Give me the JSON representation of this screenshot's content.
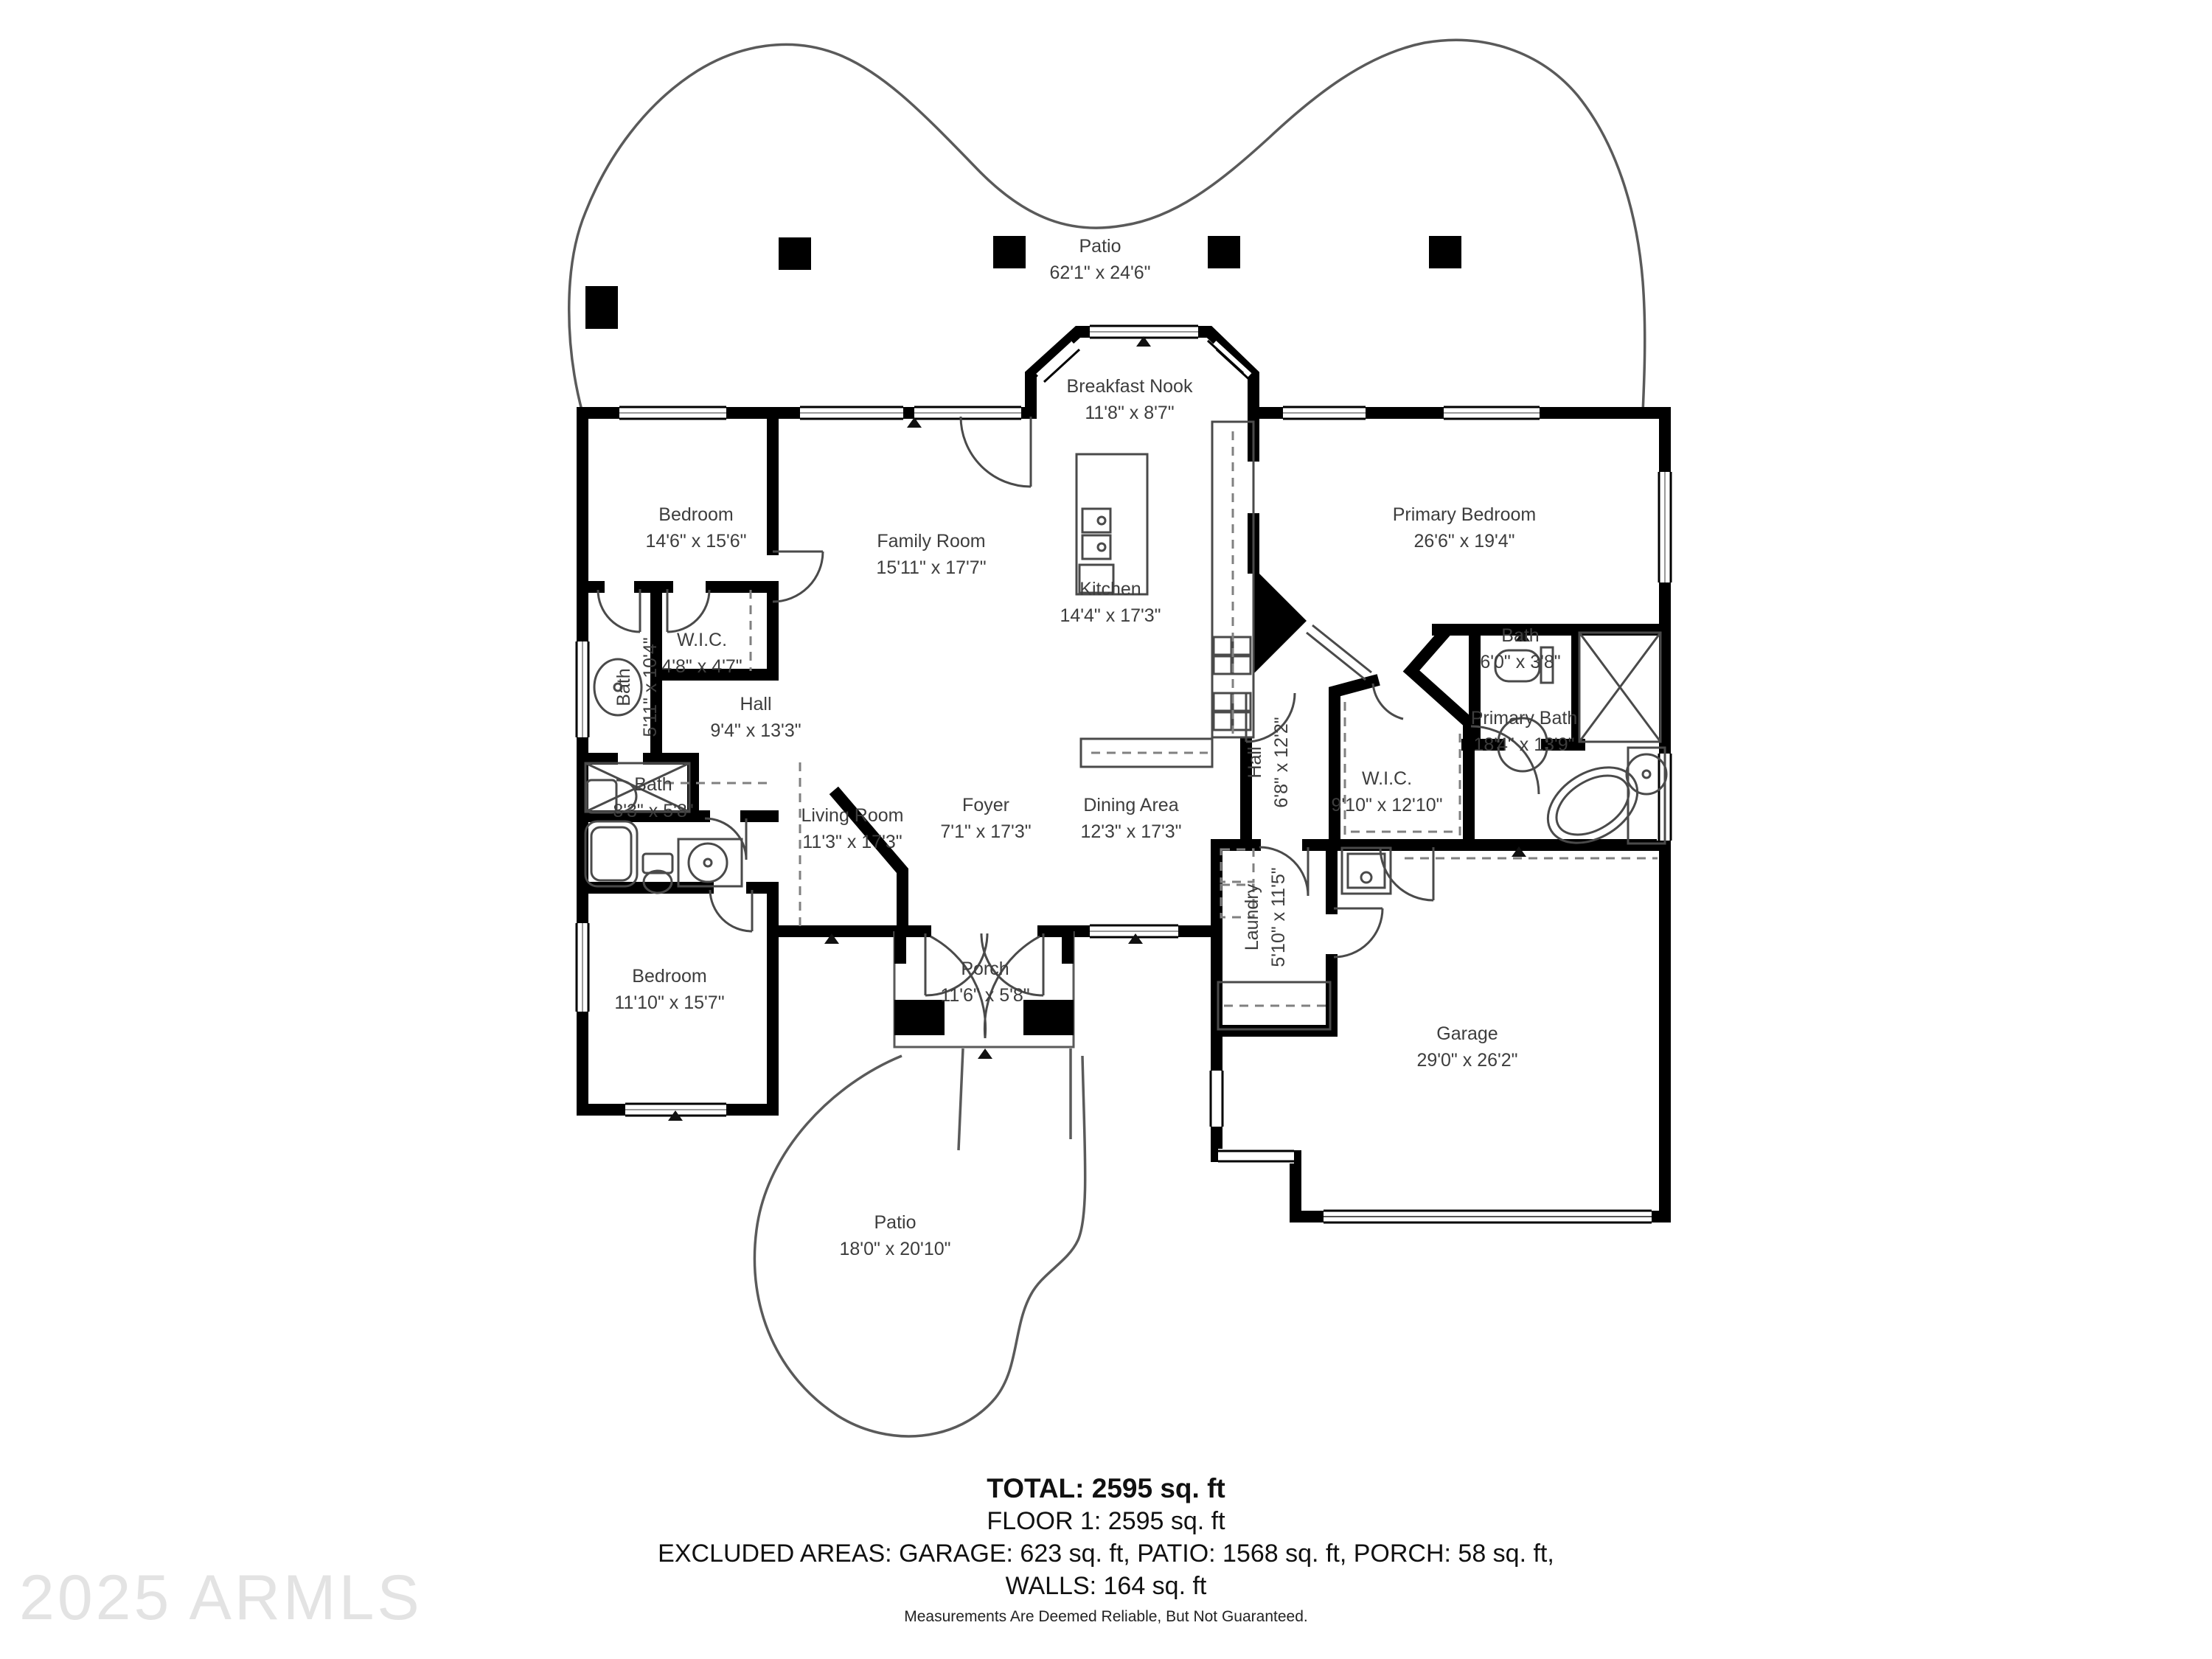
{
  "rooms": {
    "patio_top": {
      "name": "Patio",
      "dims": "62'1\" x 24'6\""
    },
    "breakfast_nook": {
      "name": "Breakfast Nook",
      "dims": "11'8\" x 8'7\""
    },
    "bedroom_top_left": {
      "name": "Bedroom",
      "dims": "14'6\" x 15'6\""
    },
    "family_room": {
      "name": "Family Room",
      "dims": "15'11\" x 17'7\""
    },
    "kitchen": {
      "name": "Kitchen",
      "dims": "14'4\" x 17'3\""
    },
    "primary_bedroom": {
      "name": "Primary Bedroom",
      "dims": "26'6\" x 19'4\""
    },
    "bath_upper_left": {
      "name": "Bath",
      "dims": "5'11\" x 10'4\""
    },
    "wic_small": {
      "name": "W.I.C.",
      "dims": "4'8\" x 4'7\""
    },
    "hall_left": {
      "name": "Hall",
      "dims": "9'4\" x 13'3\""
    },
    "bath_mid_left": {
      "name": "Bath",
      "dims": "8'3\" x 5'8\""
    },
    "living_room": {
      "name": "Living Room",
      "dims": "11'3\" x 17'3\""
    },
    "foyer": {
      "name": "Foyer",
      "dims": "7'1\" x 17'3\""
    },
    "dining_area": {
      "name": "Dining Area",
      "dims": "12'3\" x 17'3\""
    },
    "hall_kitchen": {
      "name": "Hall",
      "dims": "6'8\" x 12'2\""
    },
    "wic_primary": {
      "name": "W.I.C.",
      "dims": "9'10\" x 12'10\""
    },
    "primary_bath": {
      "name": "Primary Bath",
      "dims": "18'4\" x 13'9\""
    },
    "bath_primary_small": {
      "name": "Bath",
      "dims": "6'0\" x 3'8\""
    },
    "bedroom_bottom_left": {
      "name": "Bedroom",
      "dims": "11'10\" x 15'7\""
    },
    "porch": {
      "name": "Porch",
      "dims": "11'6\" x 5'8\""
    },
    "laundry": {
      "name": "Laundry",
      "dims": "5'10\" x 11'5\""
    },
    "garage": {
      "name": "Garage",
      "dims": "29'0\" x 26'2\""
    },
    "patio_bottom": {
      "name": "Patio",
      "dims": "18'0\" x 20'10\""
    }
  },
  "footer": {
    "total": "TOTAL: 2595 sq. ft",
    "floor": "FLOOR 1: 2595 sq. ft",
    "excluded": "EXCLUDED AREAS: GARAGE: 623 sq. ft, PATIO: 1568 sq. ft, PORCH: 58 sq. ft,",
    "walls": "WALLS: 164 sq. ft",
    "disclaimer": "Measurements Are Deemed Reliable, But Not Guaranteed."
  },
  "watermark": "2025 ARMLS",
  "colors": {
    "wall": "#000000",
    "thin_line": "#4a4a4a",
    "dashed_line": "#808080",
    "label_text": "#3d3d3d",
    "watermark": "#e3e3e3"
  }
}
